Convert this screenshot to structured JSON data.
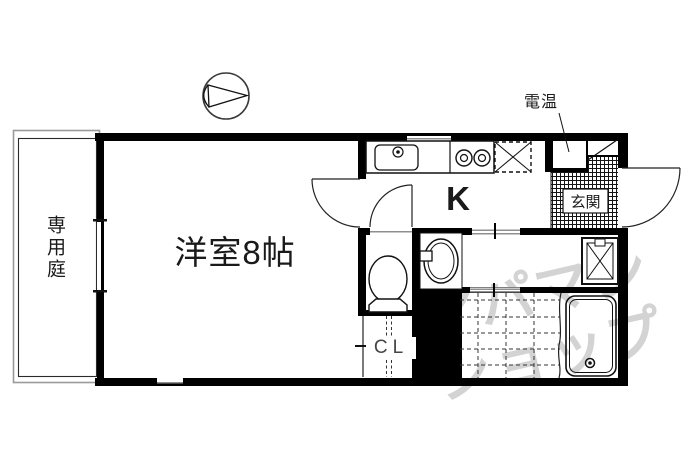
{
  "floorplan": {
    "labels": {
      "garden": "専用庭",
      "room": "洋室8帖",
      "kitchen": "K",
      "water_heater": "電温",
      "entrance": "玄関",
      "closet": "CL"
    },
    "watermark": {
      "line1": "アパマン",
      "line2": "ショップ"
    },
    "fixtures": [
      "north-compass",
      "kitchen-sink",
      "stove-burners",
      "refrigerator-space",
      "toilet",
      "washbasin",
      "washing-machine-pan",
      "bathtub",
      "bath-tile-floor",
      "entrance-tile-floor",
      "water-heater-closet",
      "closet-hanger-lines"
    ],
    "colors": {
      "wall": "#000000",
      "thin_line": "#1a1a1a",
      "window_gray": "#8f8f8f",
      "watermark_gray": "#c9c9c9",
      "background": "#ffffff"
    }
  }
}
